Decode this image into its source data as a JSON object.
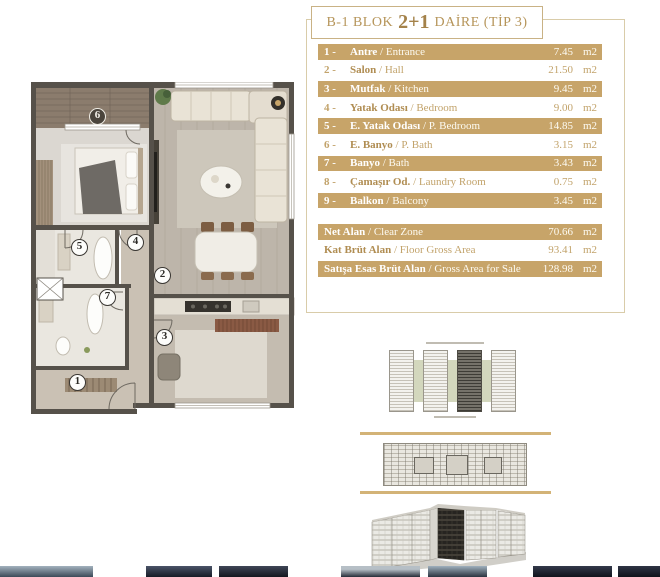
{
  "title": {
    "prefix": "B-1 BLOK",
    "rooms": "2+1",
    "suffix": "DAİRE (TİP 3)"
  },
  "table": {
    "separator": "/",
    "unit": "m2",
    "rows": [
      {
        "num": "1 -",
        "tr": "Antre",
        "en": "Entrance",
        "area": "7.45",
        "unit": "m2",
        "highlight": true
      },
      {
        "num": "2 -",
        "tr": "Salon",
        "en": "Hall",
        "area": "21.50",
        "unit": "m2",
        "highlight": false
      },
      {
        "num": "3 -",
        "tr": "Mutfak",
        "en": "Kitchen",
        "area": "9.45",
        "unit": "m2",
        "highlight": true
      },
      {
        "num": "4 -",
        "tr": "Yatak Odası",
        "en": "Bedroom",
        "area": "9.00",
        "unit": "m2",
        "highlight": false
      },
      {
        "num": "5 -",
        "tr": "E. Yatak Odası",
        "en": "P. Bedroom",
        "area": "14.85",
        "unit": "m2",
        "highlight": true
      },
      {
        "num": "6 -",
        "tr": "E. Banyo",
        "en": "P. Bath",
        "area": "3.15",
        "unit": "m2",
        "highlight": false
      },
      {
        "num": "7 -",
        "tr": "Banyo",
        "en": "Bath",
        "area": "3.43",
        "unit": "m2",
        "highlight": true
      },
      {
        "num": "8 -",
        "tr": "Çamaşır Od.",
        "en": "Laundry Room",
        "area": "0.75",
        "unit": "m2",
        "highlight": false
      },
      {
        "num": "9 -",
        "tr": "Balkon",
        "en": "Balcony",
        "area": "3.45",
        "unit": "m2",
        "highlight": true
      }
    ],
    "summary": [
      {
        "tr": "Net Alan",
        "en": "Clear Zone",
        "area": "70.66",
        "unit": "m2",
        "highlight": true
      },
      {
        "tr": "Kat Brüt Alan",
        "en": "Floor Gross Area",
        "area": "93.41",
        "unit": "m2",
        "highlight": false
      },
      {
        "tr": "Satışa Esas Brüt Alan",
        "en": "Gross Area for Sale",
        "area": "128.98",
        "unit": "m2",
        "highlight": true
      }
    ]
  },
  "floorplan": {
    "badges": [
      {
        "label": "6"
      },
      {
        "label": "5"
      },
      {
        "label": "4"
      },
      {
        "label": "2"
      },
      {
        "label": "7"
      },
      {
        "label": "3"
      },
      {
        "label": "1"
      }
    ]
  },
  "colors": {
    "accent_gold": "#c7a469",
    "rule_gold": "#d3b377",
    "wall": "#56514a",
    "highlight_row_text": "#ffffff",
    "row_text": "#c2a36b"
  }
}
